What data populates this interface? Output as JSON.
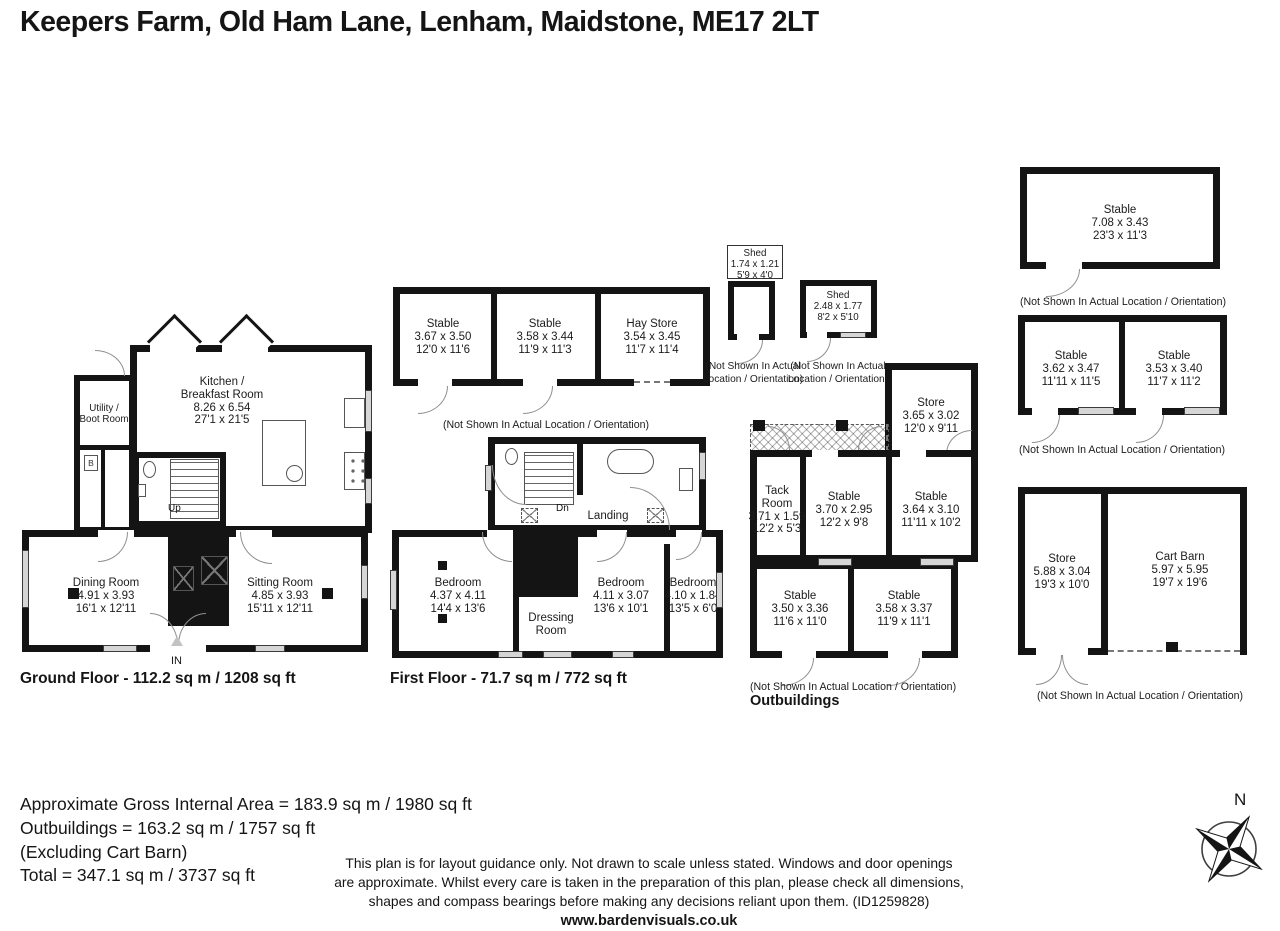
{
  "title": "Keepers Farm, Old Ham Lane, Lenham, Maidstone, ME17 2LT",
  "captions": {
    "not_shown": "(Not Shown In Actual Location / Orientation)",
    "not_shown_line1": "(Not Shown In Actual",
    "not_shown_line2": "Location / Orientation)"
  },
  "ground_floor": {
    "floor_label": "Ground Floor - 112.2 sq m / 1208 sq ft",
    "kitchen": [
      "Kitchen /",
      "Breakfast Room",
      "8.26 x 6.54",
      "27'1 x 21'5"
    ],
    "utility": [
      "Utility /",
      "Boot Room"
    ],
    "dining": [
      "Dining Room",
      "4.91 x 3.93",
      "16'1 x 12'11"
    ],
    "sitting": [
      "Sitting Room",
      "4.85 x 3.93",
      "15'11 x 12'11"
    ],
    "up": "Up",
    "in": "IN",
    "boiler": "B"
  },
  "first_floor": {
    "floor_label": "First Floor - 71.7 sq m / 772 sq ft",
    "dn": "Dn",
    "landing": "Landing",
    "bedroom1": [
      "Bedroom",
      "4.37 x 4.11",
      "14'4 x 13'6"
    ],
    "dressing_room": [
      "Dressing",
      "Room"
    ],
    "bedroom2": [
      "Bedroom",
      "4.11 x 3.07",
      "13'6 x 10'1"
    ],
    "bedroom3": [
      "Bedroom",
      "4.10 x 1.84",
      "13'5 x 6'0"
    ]
  },
  "stable_block_a": {
    "stable1": [
      "Stable",
      "3.67 x 3.50",
      "12'0 x 11'6"
    ],
    "stable2": [
      "Stable",
      "3.58 x 3.44",
      "11'9 x 11'3"
    ],
    "hay_store": [
      "Hay Store",
      "3.54 x 3.45",
      "11'7 x 11'4"
    ]
  },
  "sheds": {
    "shed1": [
      "Shed",
      "1.74 x 1.21",
      "5'9 x 4'0"
    ],
    "shed2": [
      "Shed",
      "2.48 x 1.77",
      "8'2 x 5'10"
    ]
  },
  "outbuildings": {
    "section_label": "Outbuildings",
    "store": [
      "Store",
      "3.65 x 3.02",
      "12'0 x 9'11"
    ],
    "tack_room": [
      "Tack",
      "Room",
      "3.71 x 1.59",
      "12'2 x 5'3"
    ],
    "stable1": [
      "Stable",
      "3.70 x 2.95",
      "12'2 x 9'8"
    ],
    "stable2": [
      "Stable",
      "3.64 x 3.10",
      "11'11 x 10'2"
    ],
    "stable3": [
      "Stable",
      "3.50 x 3.36",
      "11'6 x 11'0"
    ],
    "stable4": [
      "Stable",
      "3.58 x 3.37",
      "11'9 x 11'1"
    ]
  },
  "stable_block_b": {
    "stable": [
      "Stable",
      "7.08 x 3.43",
      "23'3 x 11'3"
    ]
  },
  "stable_block_c": {
    "stable1": [
      "Stable",
      "3.62 x 3.47",
      "11'11 x 11'5"
    ],
    "stable2": [
      "Stable",
      "3.53 x 3.40",
      "11'7 x 11'2"
    ]
  },
  "store_cart_barn": {
    "store": [
      "Store",
      "5.88 x 3.04",
      "19'3 x 10'0"
    ],
    "cart_barn": [
      "Cart Barn",
      "5.97 x 5.95",
      "19'7 x 19'6"
    ]
  },
  "footer": {
    "area_lines": [
      "Approximate Gross Internal Area = 183.9 sq m / 1980 sq ft",
      "Outbuildings = 163.2 sq m / 1757 sq ft",
      "(Excluding Cart Barn)",
      "Total = 347.1 sq m / 3737 sq ft"
    ],
    "disclaimer_lines": [
      "This plan is for layout guidance only. Not drawn to scale unless stated. Windows and door openings",
      "are approximate. Whilst every care is taken in the preparation of this plan, please check all dimensions,",
      "shapes and compass bearings before making any decisions reliant upon them. (ID1259828)"
    ],
    "website": "www.bardenvisuals.co.uk"
  },
  "compass": {
    "north": "N"
  }
}
